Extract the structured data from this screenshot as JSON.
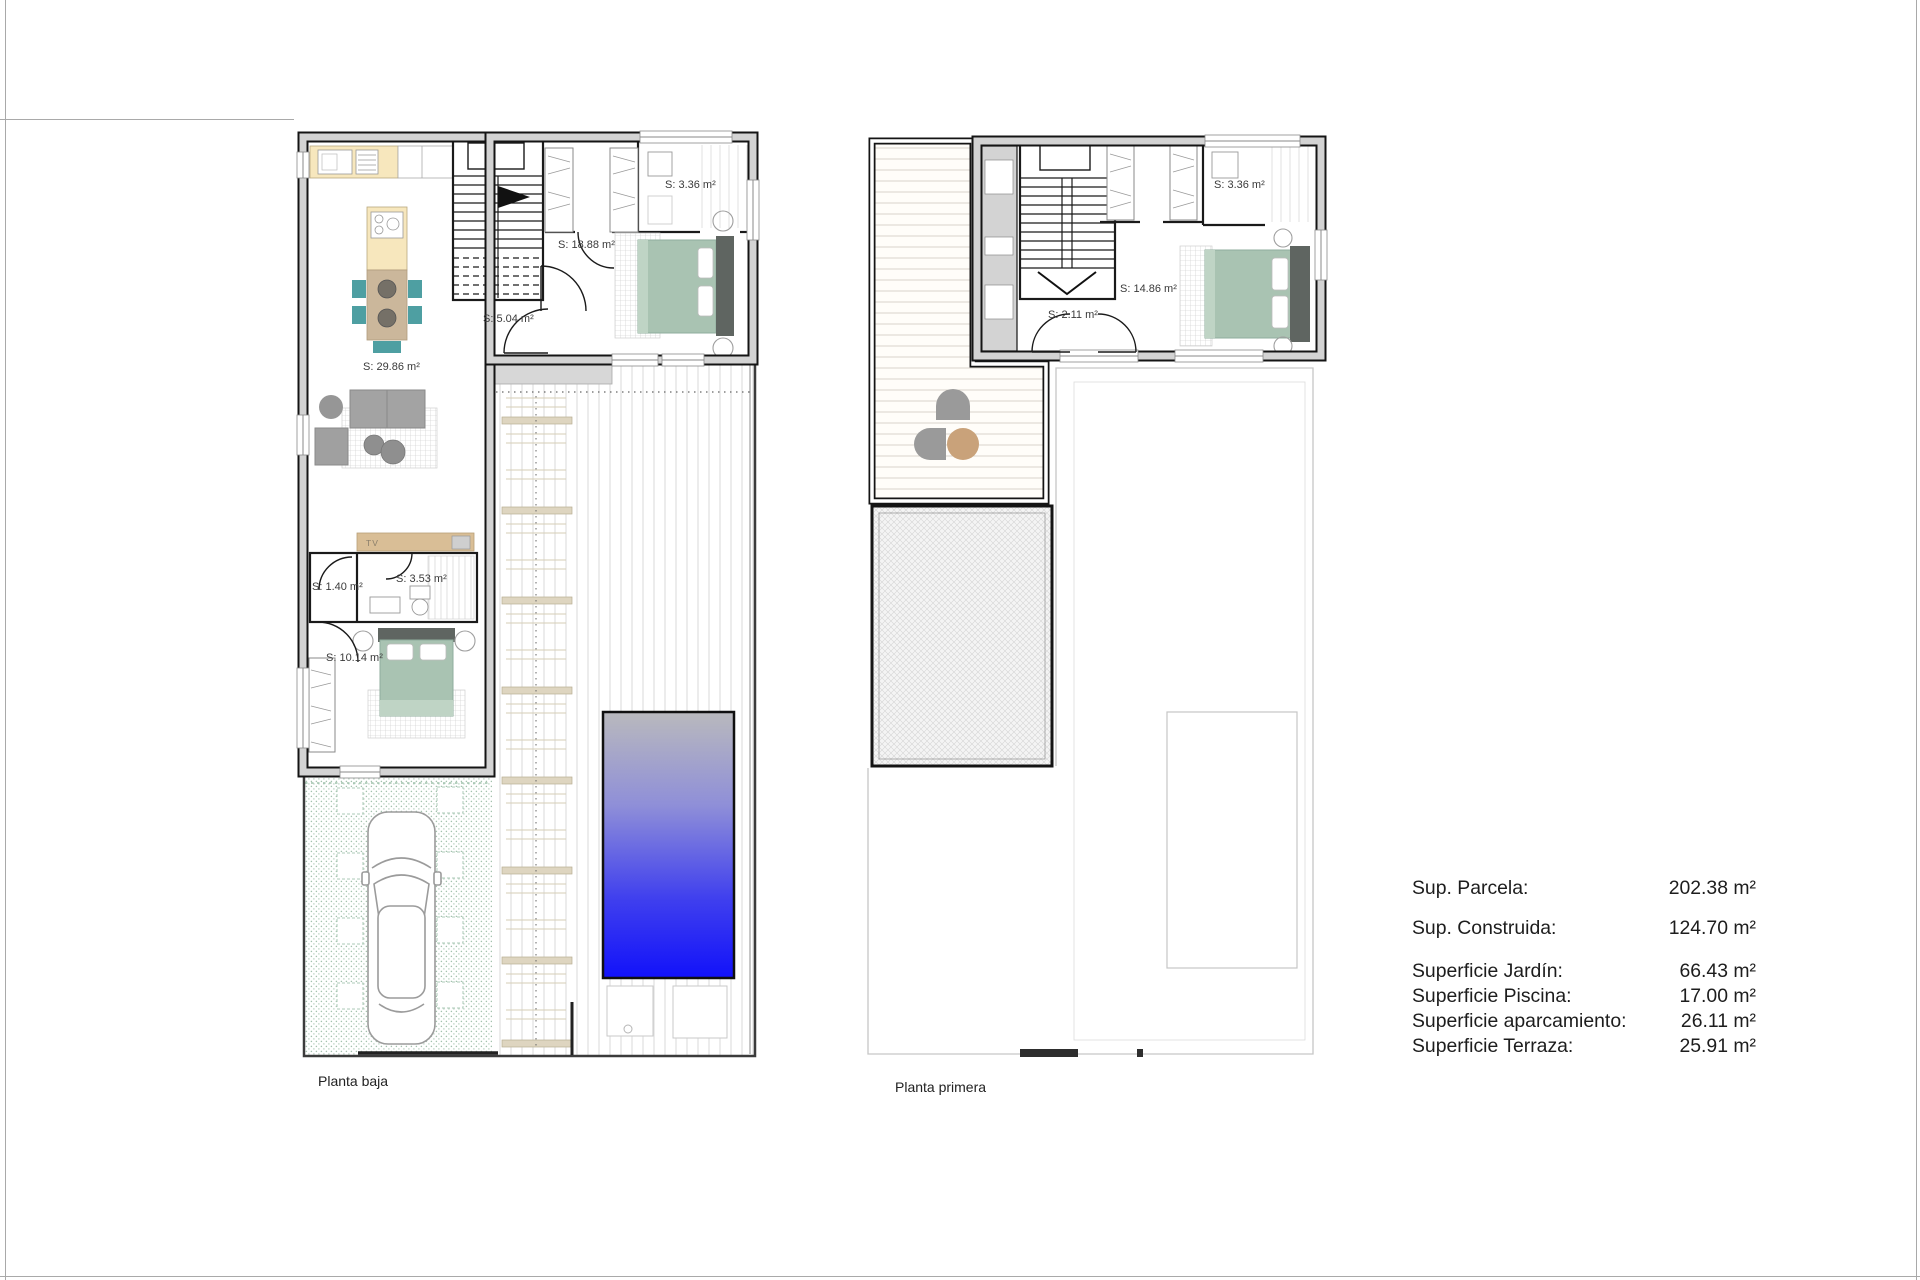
{
  "document_kind": "architectural floor plan sheet",
  "plans": [
    {
      "caption": "Planta baja",
      "room_labels": [
        "S: 29.86 m²",
        "S: 18.88 m²",
        "S: 5.04 m²",
        "S: 3.36 m²",
        "S: 1.40 m²",
        "S: 3.53 m²",
        "S: 10.14 m²"
      ],
      "tv_label": "TV"
    },
    {
      "caption": "Planta primera",
      "room_labels": [
        "S: 3.36 m²",
        "S: 2.11 m²",
        "S: 14.86 m²"
      ]
    }
  ],
  "summary": {
    "rows": [
      {
        "label": "Sup. Parcela:",
        "value": "202.38 m²"
      },
      {
        "label": "Sup. Construida:",
        "value": "124.70 m²"
      },
      {
        "label": "Superficie Jardín:",
        "value": "66.43 m²"
      },
      {
        "label": "Superficie Piscina:",
        "value": "17.00 m²"
      },
      {
        "label": "Superficie aparcamiento:",
        "value": "26.11 m²"
      },
      {
        "label": "Superficie Terraza:",
        "value": "25.91 m²"
      }
    ]
  },
  "colors": {
    "wall_fill": "#d3d3d3",
    "wall_line": "#141414",
    "kitchen_cabinet_cream": "#f7e7bd",
    "dining_table_tan": "#cbb79b",
    "chair_teal": "#4e9fa2",
    "bed_sage": "#a9c3b2",
    "headboard_gray": "#5f6561",
    "sofa_gray": "#a3a3a3",
    "terrace_table_tan": "#c9a27a",
    "garden_dot_green": "#a3c2ad",
    "pergola_tan": "#d6cdb6",
    "pool_gradient_top": "#b9b9bd",
    "pool_gradient_bottom": "#1212fa"
  },
  "icons": {
    "stairs": "stairs-icon",
    "door": "door-arc-icon",
    "bed": "bed-icon",
    "wardrobe": "wardrobe-icon",
    "sofa": "sofa-icon",
    "car": "car-icon",
    "pool": "pool-icon",
    "ceiling_fan": "ceiling-fan-icon",
    "dining_table": "dining-table-icon"
  }
}
